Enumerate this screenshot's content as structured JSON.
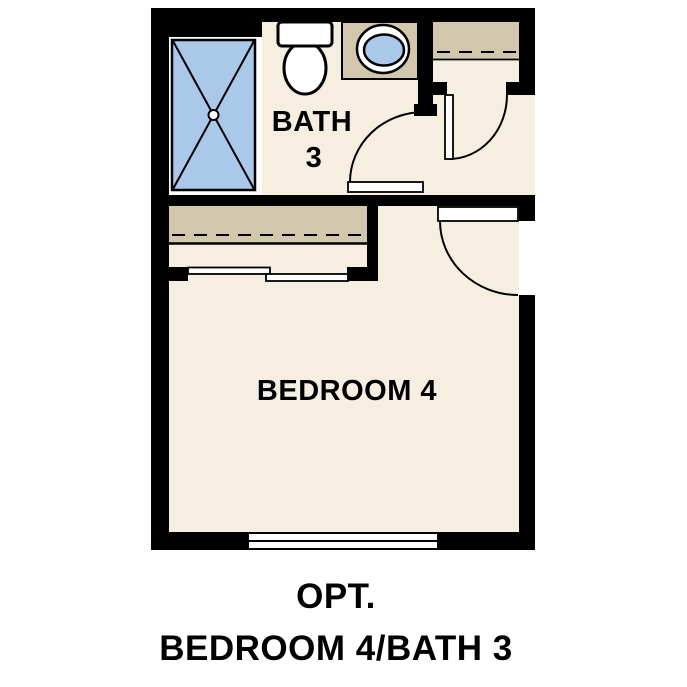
{
  "rooms": {
    "bath": {
      "name_line1": "BATH",
      "name_line2": "3"
    },
    "bedroom": {
      "name": "BEDROOM 4"
    }
  },
  "caption": {
    "line1": "OPT.",
    "line2": "BEDROOM 4/BATH 3"
  },
  "fixtures": {
    "shower": "shower-pan-with-x",
    "toilet": "toilet",
    "sink": "vanity-sink",
    "linen_shelf": "closet-shelf-with-rod",
    "bedroom_closet": "closet-shelf-with-sliding-doors",
    "window": "double-line-window"
  },
  "colors": {
    "wall": "#000000",
    "floor": "#f5eee1",
    "casework_tan": "#d2c6ad",
    "fixture_blue": "#aac9e9",
    "background": "#ffffff"
  }
}
